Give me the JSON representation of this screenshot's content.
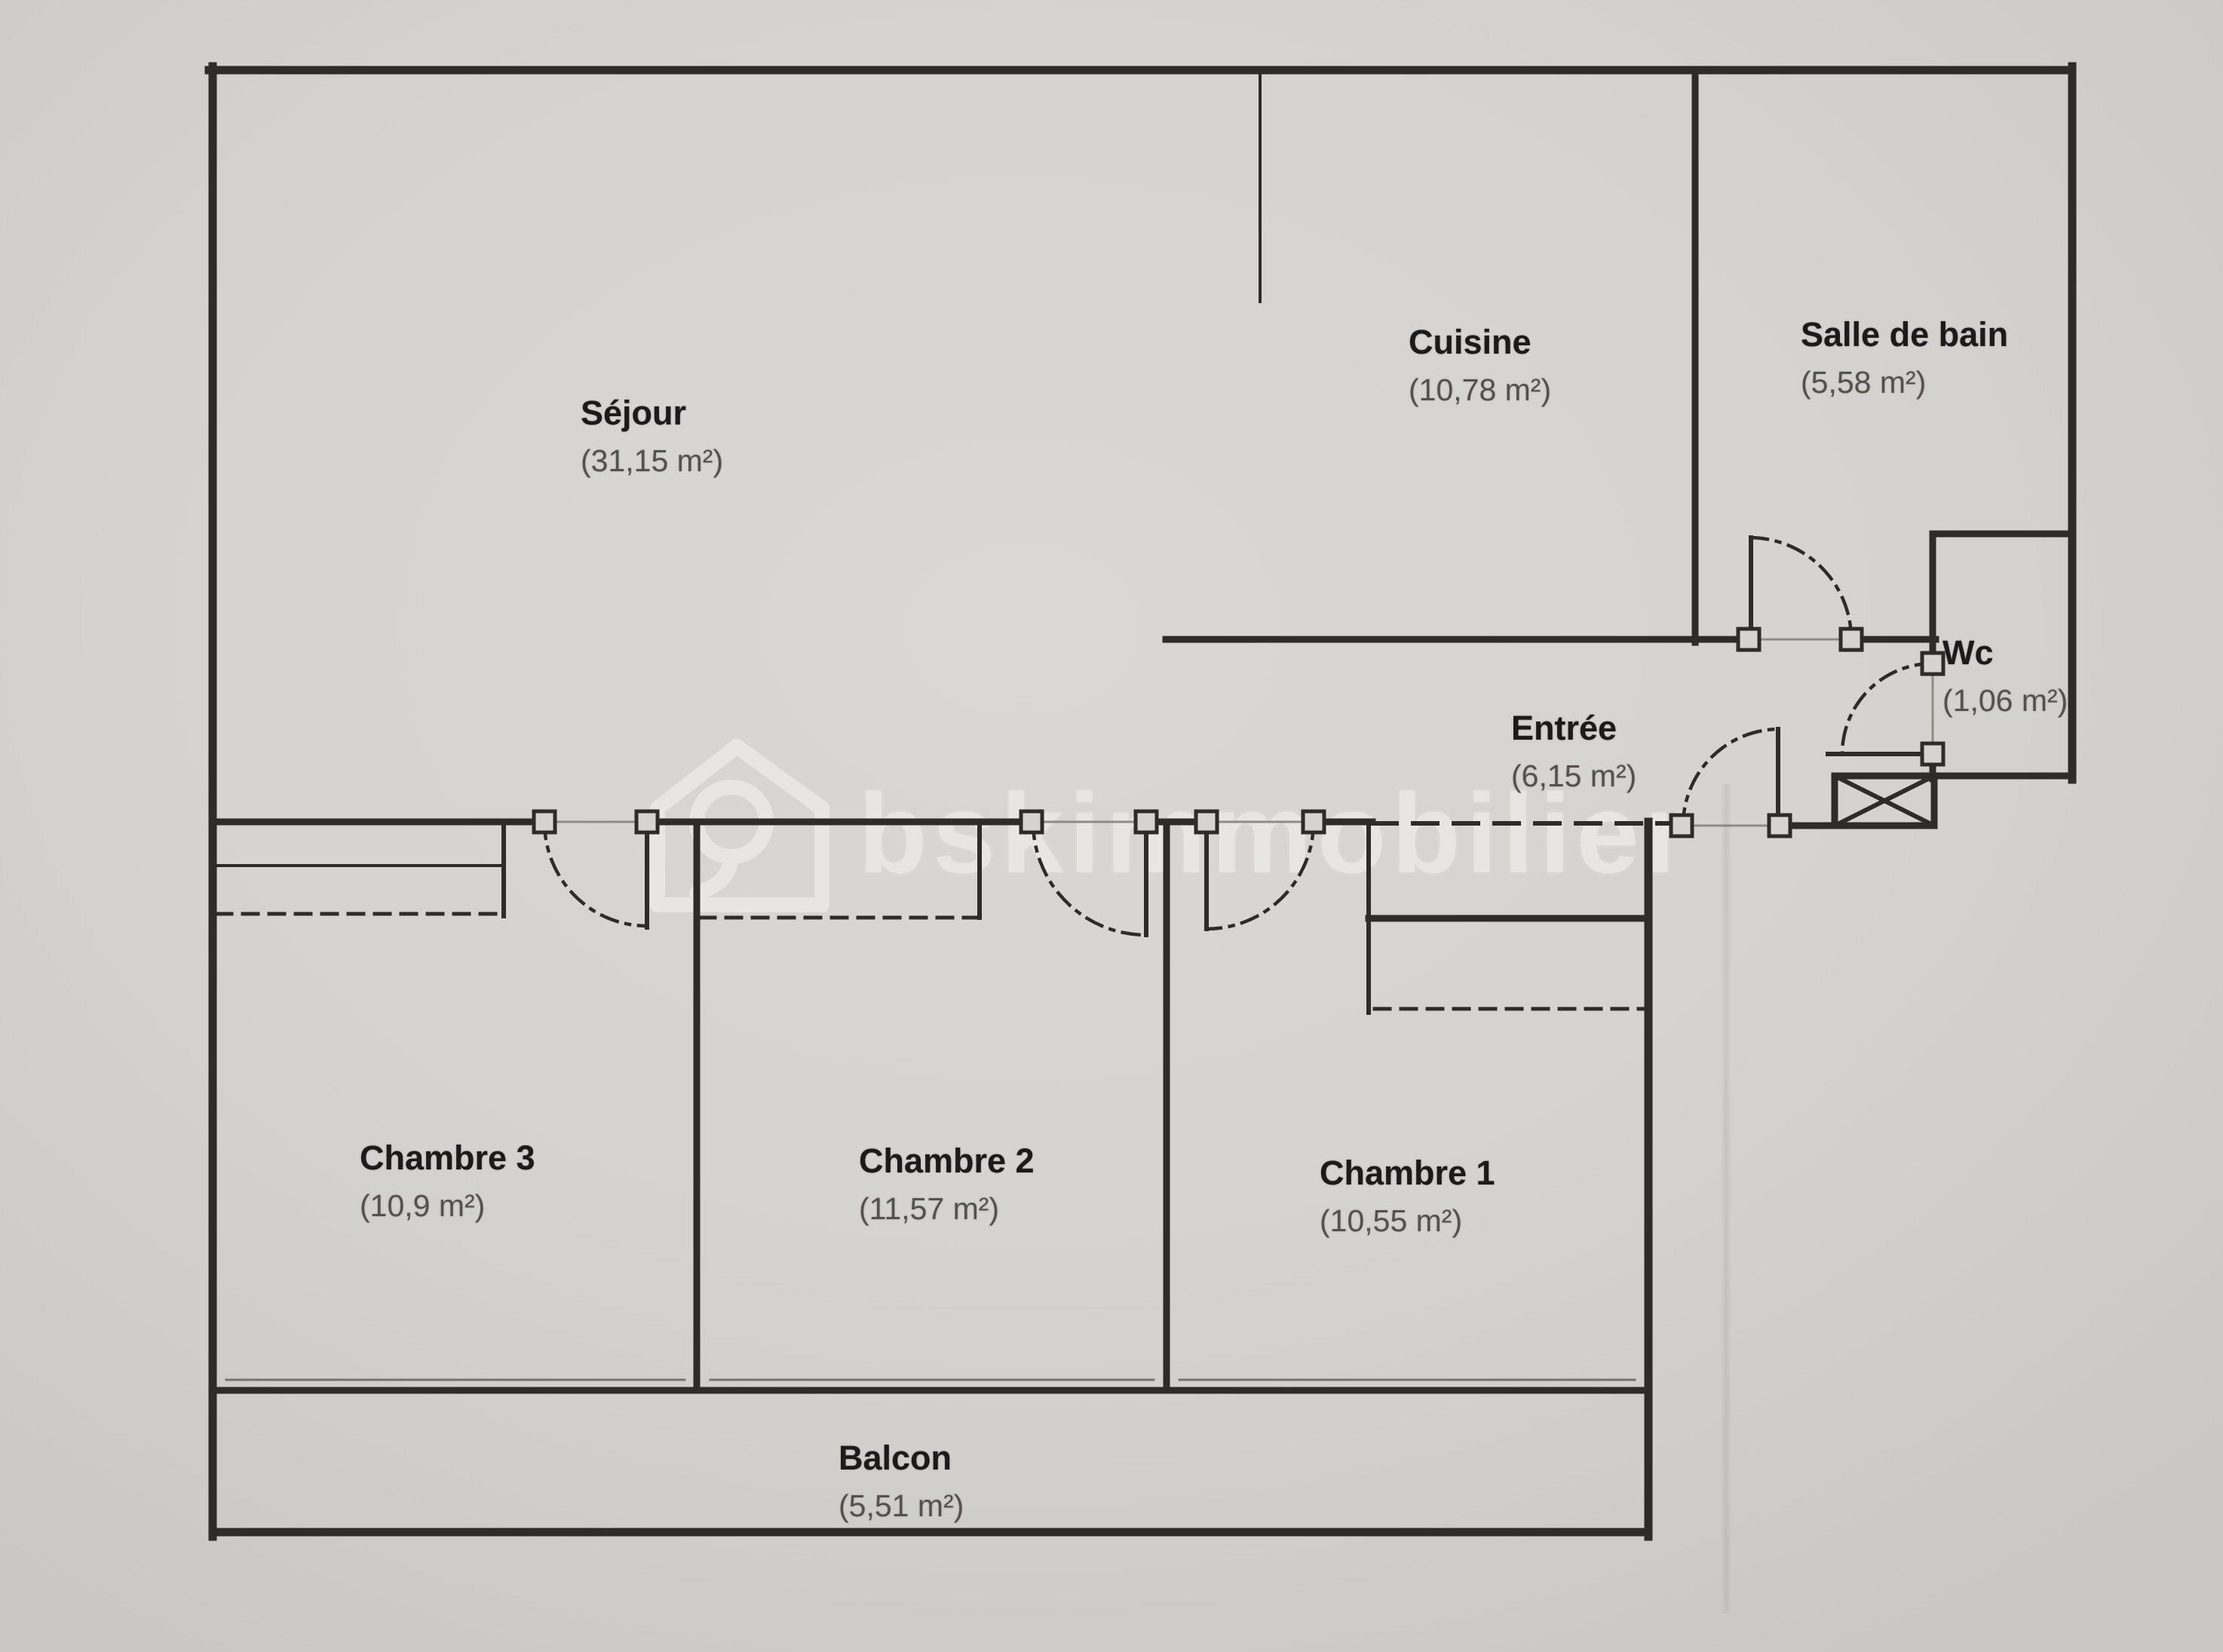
{
  "document_type": "floor-plan",
  "watermark": {
    "text": "bskimmobilier",
    "logo": "house-logo"
  },
  "rooms": [
    {
      "id": "sejour",
      "name": "Séjour",
      "area": "(31,15 m²)"
    },
    {
      "id": "cuisine",
      "name": "Cuisine",
      "area": "(10,78 m²)"
    },
    {
      "id": "salle-de-bain",
      "name": "Salle de bain",
      "area": "(5,58 m²)"
    },
    {
      "id": "wc",
      "name": "Wc",
      "area": "(1,06 m²)"
    },
    {
      "id": "entree",
      "name": "Entrée",
      "area": "(6,15 m²)"
    },
    {
      "id": "chambre-3",
      "name": "Chambre 3",
      "area": "(10,9 m²)"
    },
    {
      "id": "chambre-2",
      "name": "Chambre 2",
      "area": "(11,57 m²)"
    },
    {
      "id": "chambre-1",
      "name": "Chambre 1",
      "area": "(10,55 m²)"
    },
    {
      "id": "balcon",
      "name": "Balcon",
      "area": "(5,51 m²)"
    }
  ],
  "colors": {
    "paper": "#d5d3cf",
    "wall": "#2e2c29",
    "room_name": "#1b1b19",
    "room_area": "#55524e",
    "watermark": "#eceae6"
  }
}
